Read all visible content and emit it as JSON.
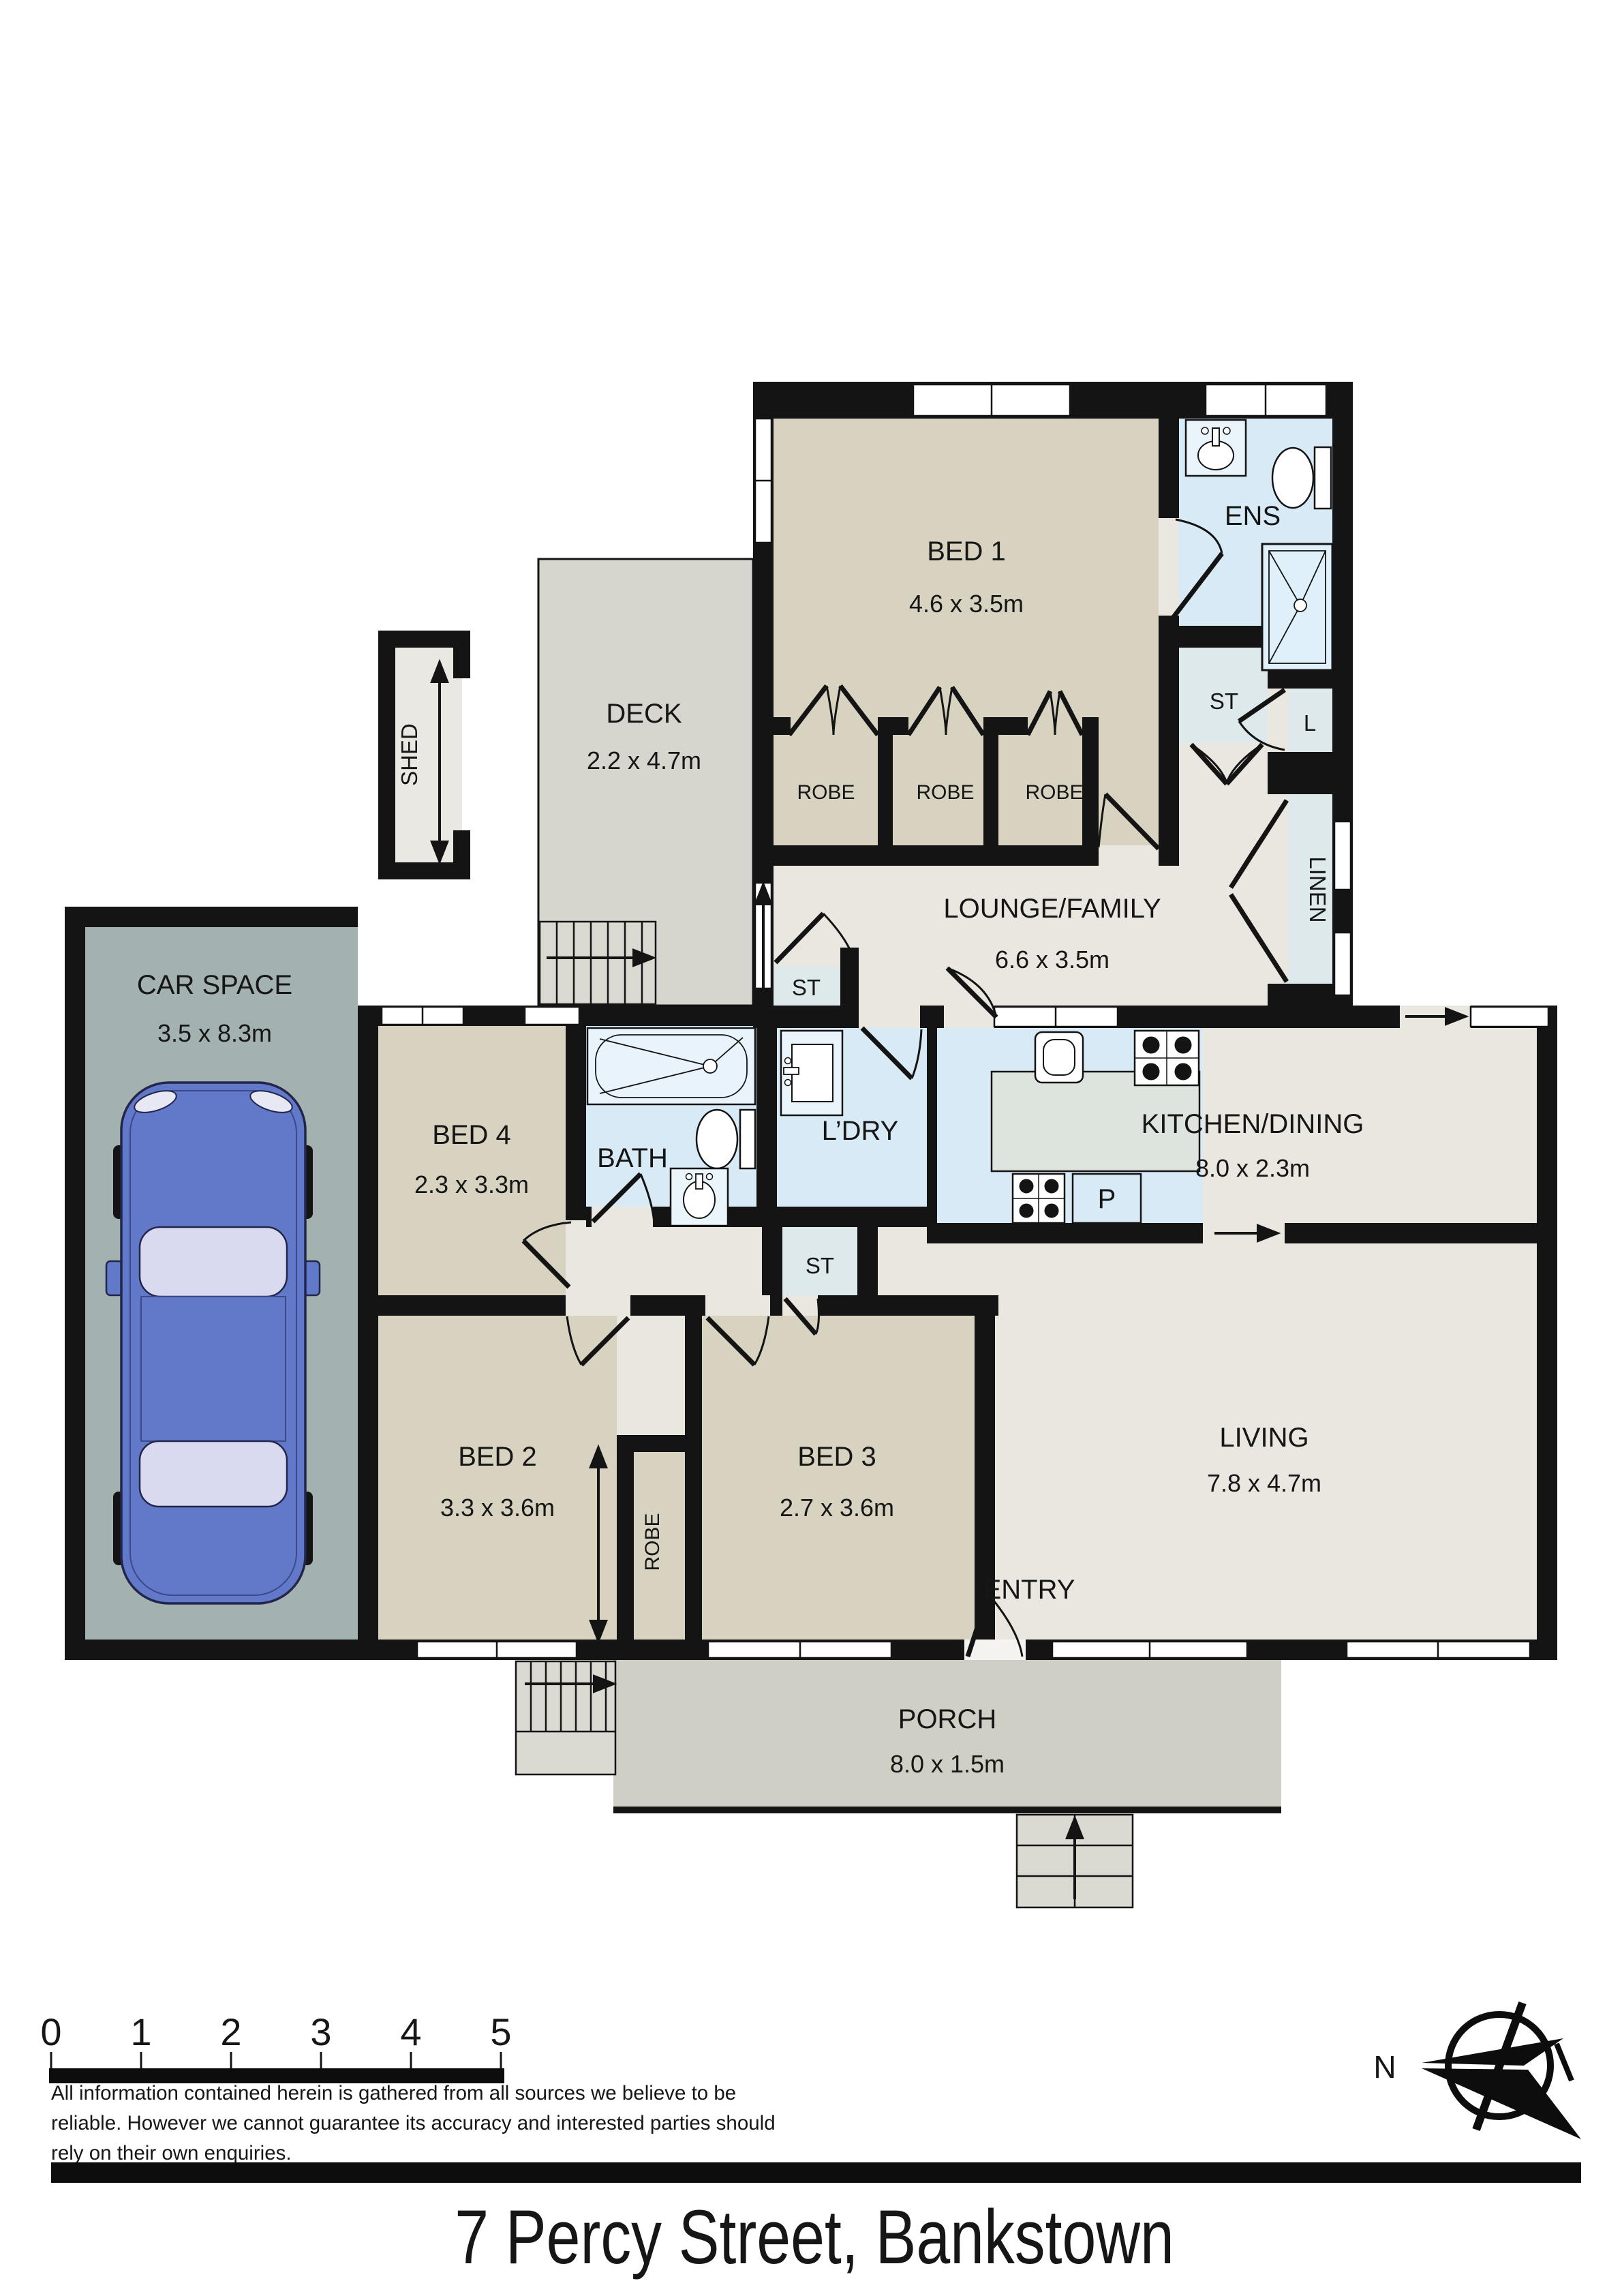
{
  "title": "7 Percy Street, Bankstown",
  "compass": {
    "north_label": "N"
  },
  "scale_bar": {
    "ticks": [
      "0",
      "1",
      "2",
      "3",
      "4",
      "5"
    ]
  },
  "disclaimer": {
    "line1": "All information contained herein is gathered from all sources we believe to be",
    "line2": "reliable. However we cannot guarantee its accuracy and interested parties should",
    "line3": "rely on their own enquiries."
  },
  "rooms": {
    "bed1": {
      "name": "BED 1",
      "dims": "4.6 x 3.5m"
    },
    "ens": {
      "name": "ENS"
    },
    "st_ens": {
      "name": "ST"
    },
    "l_closet": {
      "name": "L"
    },
    "linen": {
      "name": "LINEN"
    },
    "robe1": {
      "name": "ROBE"
    },
    "robe2": {
      "name": "ROBE"
    },
    "robe3": {
      "name": "ROBE"
    },
    "lounge": {
      "name": "LOUNGE/FAMILY",
      "dims": "6.6 x 3.5m"
    },
    "deck": {
      "name": "DECK",
      "dims": "2.2 x 4.7m"
    },
    "shed": {
      "name": "SHED"
    },
    "car_space": {
      "name": "CAR SPACE",
      "dims": "3.5 x 8.3m"
    },
    "bed4": {
      "name": "BED 4",
      "dims": "2.3 x 3.3m"
    },
    "bath": {
      "name": "BATH"
    },
    "laundry": {
      "name": "L’DRY"
    },
    "st_lounge": {
      "name": "ST"
    },
    "st_hall": {
      "name": "ST"
    },
    "kitchen": {
      "name": "KITCHEN/DINING",
      "dims": "8.0 x 2.3m"
    },
    "pantry": {
      "name": "P"
    },
    "bed2": {
      "name": "BED 2",
      "dims": "3.3 x 3.6m"
    },
    "robe_strip": {
      "name": "ROBE"
    },
    "bed3": {
      "name": "BED 3",
      "dims": "2.7 x 3.6m"
    },
    "entry": {
      "name": "ENTRY"
    },
    "living": {
      "name": "LIVING",
      "dims": "7.8 x 4.7m"
    },
    "porch": {
      "name": "PORCH",
      "dims": "8.0 x 1.5m"
    }
  },
  "colors": {
    "wall": "#141414",
    "bedroom_fill": "#d7d3c0",
    "living_fill": "#eae7e0",
    "wet_area_fill": "#d8eaf6",
    "closet_fill": "#dde9ea",
    "island_fill": "#dde4dd",
    "deck_fill": "#d6d6ce",
    "porch_fill": "#cfcfc6",
    "stairs_fill": "#dadad2",
    "car_space_fill": "#a3b2b0",
    "car_body": "#6278c8",
    "car_glass": "#d9daf0"
  }
}
